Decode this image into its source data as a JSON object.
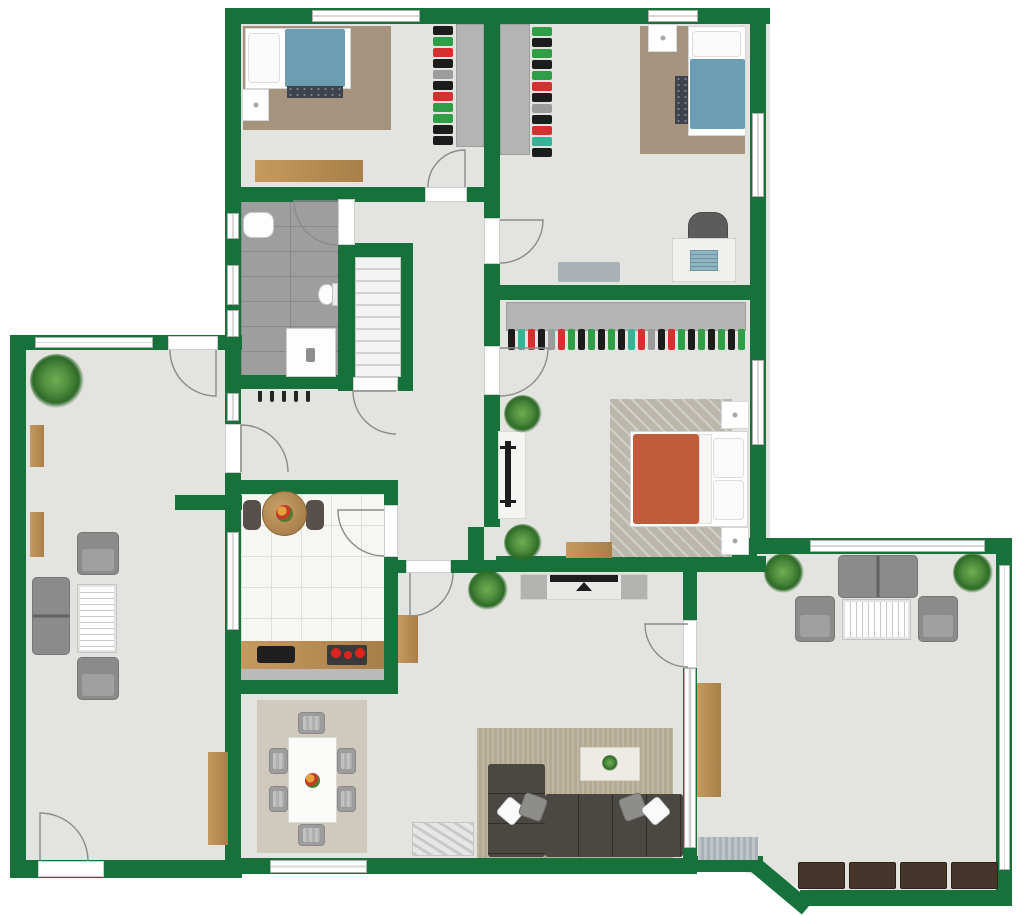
{
  "meta": {
    "type": "2d-floor-plan",
    "width_px": 1024,
    "height_px": 915,
    "visible_text": "none"
  },
  "palette": {
    "wall": "#17713B",
    "floor": "#E3E3E0",
    "tile": "#9E9E9E",
    "tile_line": "#8A8A8A",
    "kitchen_floor": "#F6F6F3",
    "kitchen_line": "#DEDEDA",
    "wood": "#C69A5E",
    "wood_dark": "#A87F49",
    "rug_brown": "#A6937E",
    "rug_master": "#BBB7AC",
    "rug_dining": "#CFCABD",
    "rug_living": "#B3AA93",
    "bed_blue": "#6B9DB3",
    "bed_orange": "#C05B3C",
    "sofa_dark": "#4B4742",
    "seat_gray": "#8B8B8B",
    "closet_gray": "#B4B4B4",
    "window_frame": "#ADADAD",
    "door_line": "#8B8B8B",
    "plant_light": "#6FAE52",
    "plant_dark": "#2E6B27",
    "chest": "#46352A",
    "mat": "#A9B0B6",
    "black": "#1D1D1D",
    "stripe_line": "#C9C9C9",
    "counter_edge": "#BABABA",
    "burner_red": "#D9251D"
  },
  "rooms": {
    "bedroom_top_left": {
      "furniture": [
        "single-bed-blue",
        "area-rug-brown",
        "nightstand",
        "foot-runner",
        "clothes-rail",
        "wardrobe-panel",
        "wooden-dresser"
      ]
    },
    "bedroom_top_right": {
      "furniture": [
        "wardrobe-panel",
        "clothes-rail",
        "single-bed-blue",
        "area-rug-brown",
        "nightstand",
        "desk",
        "laptop",
        "desk-chair",
        "floor-mat"
      ]
    },
    "bathroom": {
      "furniture": [
        "bathtub",
        "toilet",
        "shower"
      ]
    },
    "stairwell": {
      "furniture": [
        "staircase"
      ]
    },
    "entry_hall": {
      "furniture": [
        "coat-rack"
      ]
    },
    "master_bedroom": {
      "furniture": [
        "closet-clothes-rail",
        "tv-stand",
        "tv",
        "double-bed-orange",
        "nightstand",
        "nightstand",
        "herringbone-rug",
        "wooden-bench",
        "plant",
        "plant"
      ]
    },
    "kitchen": {
      "furniture": [
        "round-table",
        "fruit-bowl",
        "chair",
        "chair",
        "counter",
        "sink",
        "cooktop-4-burners"
      ]
    },
    "dining_room": {
      "furniture": [
        "dining-table",
        "fruit-bowl",
        "six-chairs",
        "area-rug"
      ]
    },
    "living_room": {
      "furniture": [
        "media-console",
        "tv",
        "plant",
        "corner-sofa-dark",
        "four-pillows",
        "coffee-table",
        "area-rug",
        "marble-ottoman",
        "wall-shelf"
      ]
    },
    "left_lounge": {
      "furniture": [
        "plant",
        "wall-shelf",
        "wall-shelf",
        "armchair",
        "armchair",
        "loveseat",
        "striped-coffee-table",
        "sideboard"
      ]
    },
    "sunroom": {
      "furniture": [
        "loveseat",
        "armchair",
        "armchair",
        "striped-coffee-table",
        "plant",
        "plant",
        "tall-cabinet",
        "doormat",
        "storage-chests"
      ]
    }
  },
  "counts": {
    "stair_steps": 10,
    "dining_chairs": 6,
    "coat_hooks": 5,
    "storage_chests": 4,
    "doors": 11,
    "master_closet_garments": 24
  },
  "clothes_rails": {
    "bedroom_top_left": [
      "#1c1c1c",
      "#2f9e47",
      "#d53030",
      "#1c1c1c",
      "#9b9b9b",
      "#1c1c1c",
      "#d53030",
      "#2f9e47",
      "#2f9e47",
      "#1c1c1c",
      "#1c1c1c"
    ],
    "bedroom_top_right": [
      "#2f9e47",
      "#1c1c1c",
      "#2f9e47",
      "#1c1c1c",
      "#2f9e47",
      "#d53030",
      "#1c1c1c",
      "#9b9b9b",
      "#1c1c1c",
      "#d53030",
      "#35b394",
      "#1c1c1c"
    ],
    "master_closet": [
      "#1c1c1c",
      "#35b394",
      "#d53030",
      "#1c1c1c",
      "#9b9b9b",
      "#d53030",
      "#2f9e47",
      "#1c1c1c",
      "#2f9e47",
      "#1c1c1c",
      "#2f9e47",
      "#1c1c1c",
      "#35b394",
      "#d53030",
      "#9b9b9b",
      "#1c1c1c",
      "#d53030",
      "#2f9e47",
      "#1c1c1c",
      "#2f9e47",
      "#1c1c1c",
      "#2f9e47",
      "#1c1c1c",
      "#2f9e47"
    ]
  },
  "repeat_items": {
    "coat_hooks": [
      "#232323",
      "#232323",
      "#232323",
      "#232323",
      "#232323"
    ],
    "storage_chests": [
      "#46352A",
      "#46352A",
      "#46352A",
      "#46352A"
    ]
  }
}
